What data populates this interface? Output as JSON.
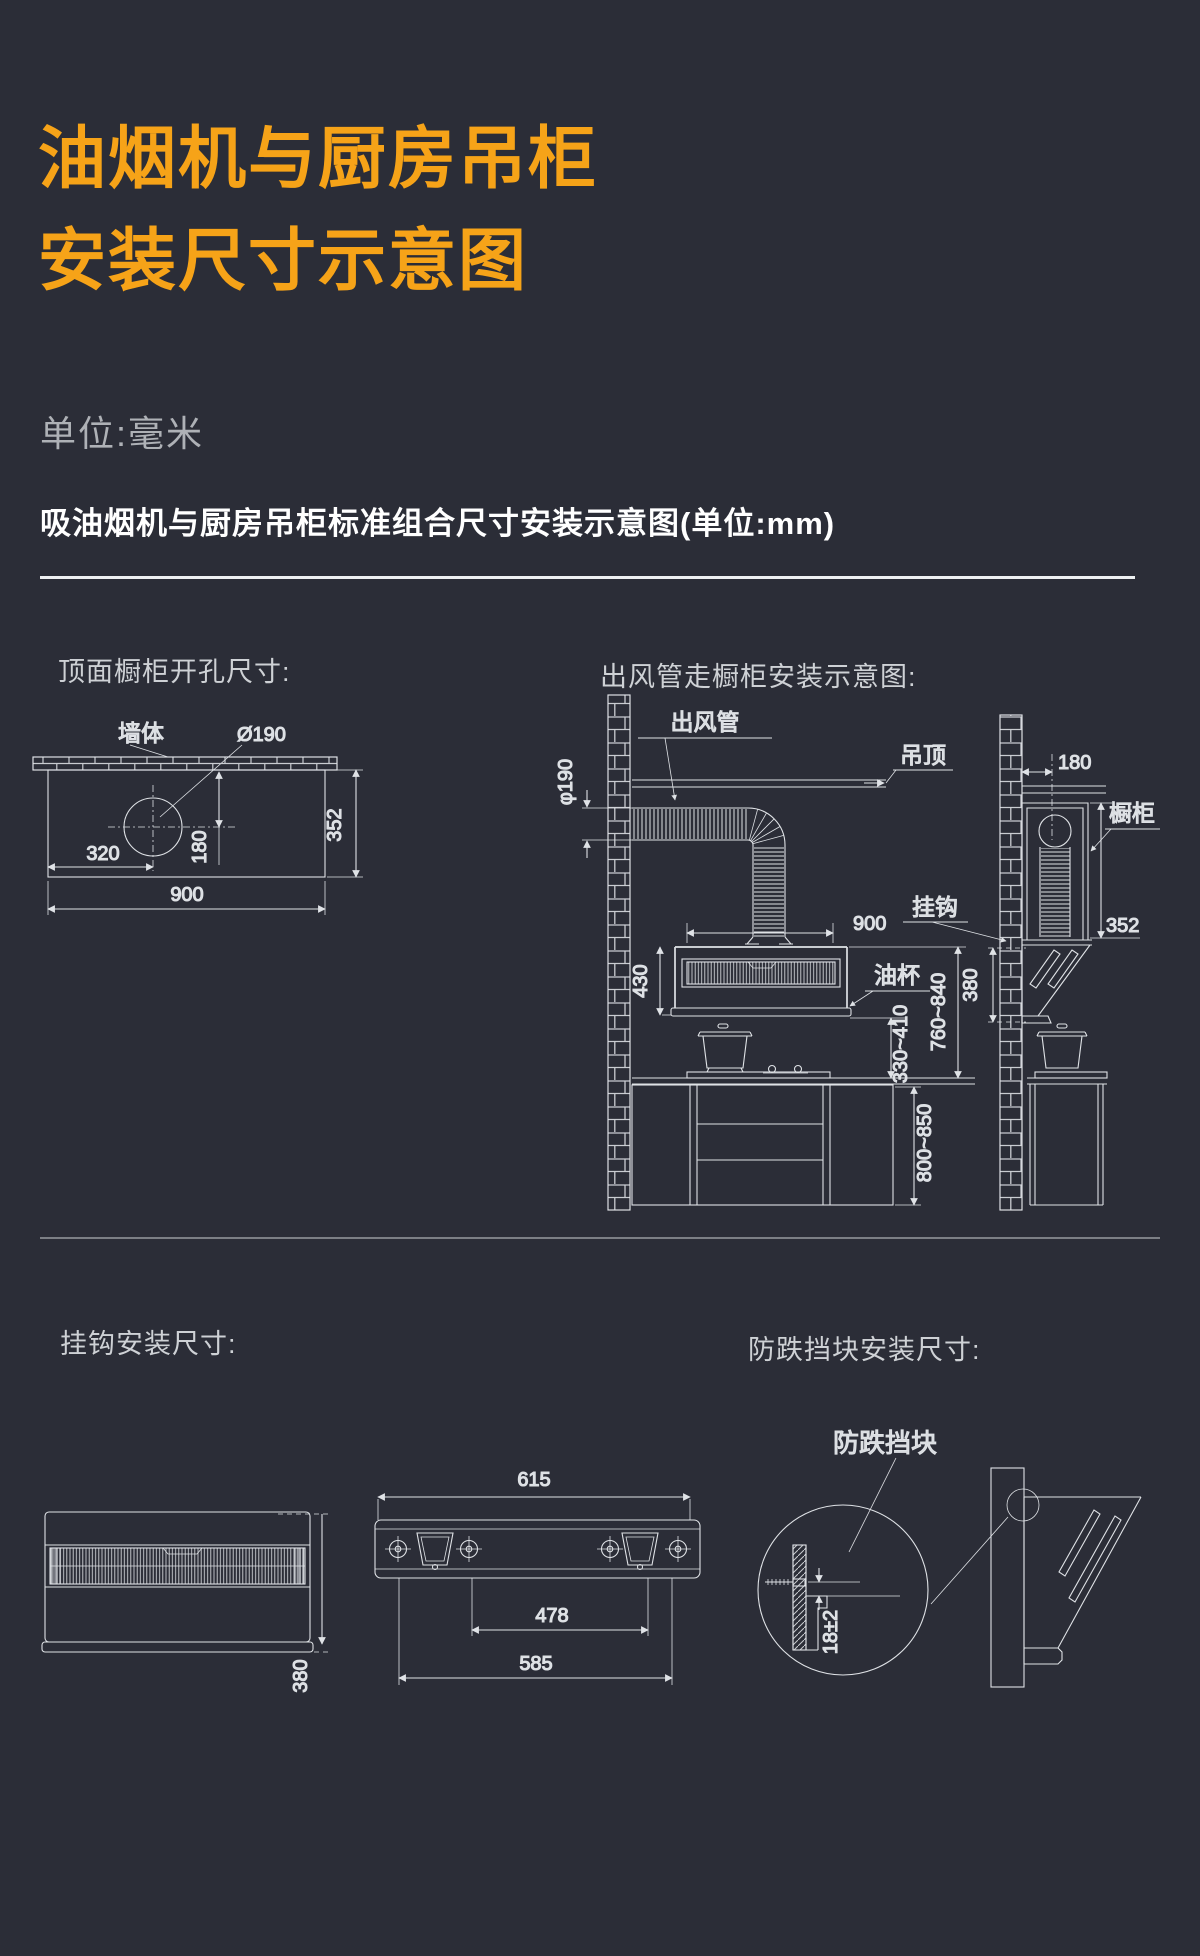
{
  "page": {
    "bg": "#2b2d37",
    "accent": "#F6A318",
    "line_color": "#dfe2e6"
  },
  "title": {
    "line1": "油烟机与厨房吊柜",
    "line2": "安装尺寸示意图"
  },
  "unit_note": "单位:毫米",
  "section_heading": "吸油烟机与厨房吊柜标准组合尺寸安装示意图(单位:mm)",
  "diagrams": {
    "cutout": {
      "heading": "顶面橱柜开孔尺寸:",
      "labels": {
        "wall": "墙体",
        "hole": "Ø190"
      },
      "dims": {
        "offset_x": "320",
        "offset_y": "180",
        "depth": "352",
        "width": "900"
      }
    },
    "duct": {
      "heading": "出风管走橱柜安装示意图:",
      "labels": {
        "duct": "出风管",
        "ceiling": "吊顶",
        "hook": "挂钩",
        "oil_cup": "油杯",
        "cabinet": "橱柜"
      },
      "dims": {
        "duct_dia": "φ190",
        "hood_width": "900",
        "hood_height": "430",
        "hood_to_counter": "330~410",
        "counter_to_hood_top": "760~840",
        "counter_height": "800~850",
        "wall_gap": "180",
        "cabinet_depth": "352",
        "hook_height": "380"
      }
    },
    "hook": {
      "heading": "挂钩安装尺寸:",
      "dims": {
        "bar_width": "615",
        "hole_span": "478",
        "outer_span": "585",
        "hood_depth": "380"
      }
    },
    "block": {
      "heading": "防跌挡块安装尺寸:",
      "label": "防跌挡块",
      "dims": {
        "gap": "18±2"
      }
    }
  }
}
